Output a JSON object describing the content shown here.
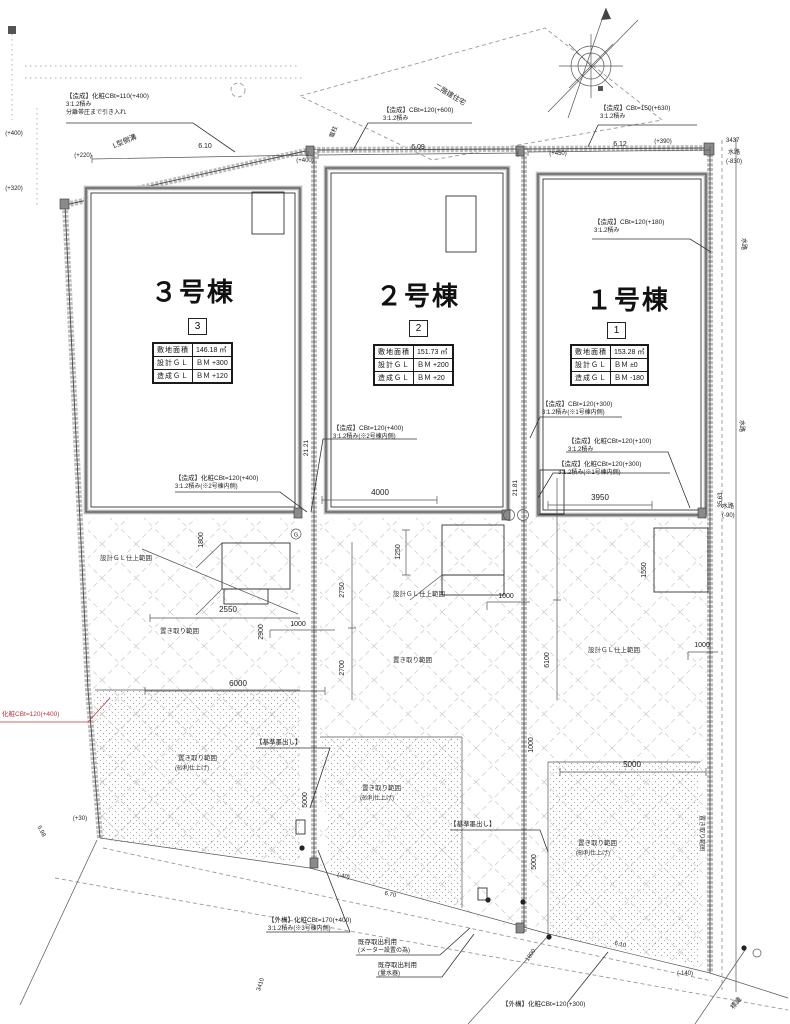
{
  "buildings": [
    {
      "title": "３号棟",
      "num": "3",
      "area_label": "敷地面積",
      "area": "146.18 ㎡",
      "design_label": "設計ＧＬ",
      "design": "ＢＭ +300",
      "grading_label": "造成ＧＬ",
      "grading": "ＢＭ +120"
    },
    {
      "title": "２号棟",
      "num": "2",
      "area_label": "敷地面積",
      "area": "151.73 ㎡",
      "design_label": "設計ＧＬ",
      "design": "ＢＭ +200",
      "grading_label": "造成ＧＬ",
      "grading": "ＢＭ +20"
    },
    {
      "title": "１号棟",
      "num": "1",
      "area_label": "敷地面積",
      "area": "153.28 ㎡",
      "design_label": "設計ＧＬ",
      "design": "ＢＭ ±0",
      "grading_label": "造成ＧＬ",
      "grading": "ＢＭ -180"
    }
  ],
  "callouts": {
    "tl1": "【造成】化粧CBt=110(+400)",
    "tl2": "3:1.2積み",
    "tl3": "分離帯圧まで引き入れ",
    "tm1": "【造成】CBt=120(+600)",
    "tm2": "3:1.2積み",
    "tr1": "【造成】CBt=150(+630)",
    "tr2": "3:1.2積み",
    "r1a": "【造成】CBt=120(+180)",
    "r1b": "3:1.2積み",
    "m2a1": "【造成】CBt=120(+400)",
    "m2a2": "3:1.2積み(※2号棟内側)",
    "m2b1": "【造成】化粧CBt=120(+400)",
    "m2b2": "3:1.2積み(※2号棟内側)",
    "r2a1": "【造成】CBt=120(+300)",
    "r2a2": "3:1.2積み(※1号棟内側)",
    "r2b1": "【造成】化粧CBt=120(+100)",
    "r2b2": "3:1.2積み",
    "r2c1": "【造成】化粧CBt=120(+300)",
    "r2c2": "3:1.2積み(※1号棟内側)",
    "red1": "化粧CBt=120(+400)",
    "b1a": "【外構】化粧CBt=170(+400)",
    "b1b": "3:1.2積み(※3号棟内側)",
    "b2a": "既存取出利用",
    "b2b": "(メーター設置の為)",
    "b3a": "既存取出利用",
    "b3b": "(量水器)",
    "b4a": "【外構】化粧CBt=120(+300)",
    "k1": "【基準墨出し】",
    "k2": "【基準墨出し】"
  },
  "areas": {
    "sekkei": "設計ＧＬ仕上範囲",
    "oki": "置き取り範囲",
    "jari": "(砂利仕上げ)"
  },
  "labels": {
    "lgutter": "L型側溝",
    "house": "二階建住宅",
    "pole": "電柱",
    "waterway": "水路",
    "sign": "標識",
    "markG": "G"
  },
  "dims": {
    "t1": "6.10",
    "t2": "6.09",
    "t3": "6.12",
    "p220": "(+220)",
    "p320": "(+320)",
    "p400a": "(+400)",
    "p400b": "(+400)",
    "p450": "(+450)",
    "p390": "(+390)",
    "r3437": "3437",
    "m830": "(-830)",
    "v3563": "35.63",
    "m90": "(-90)",
    "m140": "(-140)",
    "v2121": "21.21",
    "v2181": "21.81",
    "d4000": "4000",
    "d3950": "3950",
    "d2550": "2550",
    "d6000": "6000",
    "v1800": "1800",
    "v2900": "2900",
    "v2750": "2750",
    "v2700": "2700",
    "v1250": "1250",
    "v6100": "6100",
    "v1550": "1550",
    "n1000a": "1000",
    "n1000b": "1000",
    "n1000c": "1000",
    "n1000d": "1000",
    "d5000a": "5000",
    "v5000b": "5000",
    "v5000c": "5000",
    "v3410": "3410",
    "d1800b": "1800",
    "e670": "6.70",
    "e610": "6.10",
    "e598": "5.98",
    "p30": "(+30)",
    "m40": "(-40)"
  }
}
